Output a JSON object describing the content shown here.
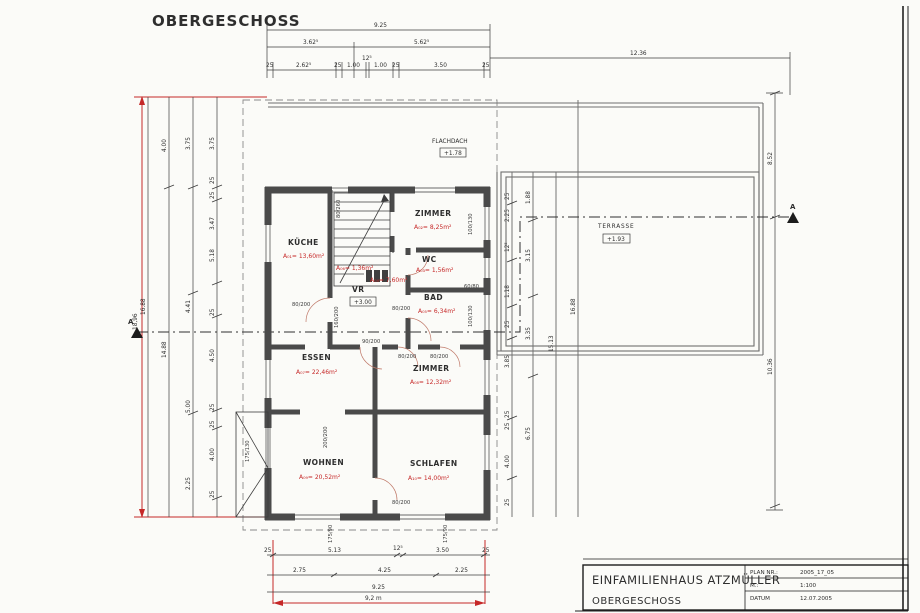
{
  "title": "OBERGESCHOSS",
  "section_marker": "A",
  "labels": {
    "flachdach": "FLACHDACH",
    "flachdach_level": "+1.78",
    "terrasse": "TERRASSE",
    "terrasse_level": "+1.93",
    "vr_level": "+3.00"
  },
  "rooms": [
    {
      "name": "KÜCHE",
      "area": "A₀₁= 13,60m²"
    },
    {
      "name": "ZIMMER",
      "area": "A₀₂= 8,25m²"
    },
    {
      "name": "WC",
      "area": "A₀₃= 1,56m²"
    },
    {
      "name": "VR",
      "area": "A₀₄= 7,60m²"
    },
    {
      "name": "BAD",
      "area": "A₀₅= 6,34m²"
    },
    {
      "name": "",
      "area": "A₀₆= 1,36m²"
    },
    {
      "name": "ESSEN",
      "area": "A₀₇= 22,46m²"
    },
    {
      "name": "ZIMMER",
      "area": "A₀₈= 12,32m²"
    },
    {
      "name": "WOHNEN",
      "area": "A₀₉= 20,52m²"
    },
    {
      "name": "SCHLAFEN",
      "area": "A₁₀= 14,00m²"
    }
  ],
  "dims": {
    "top_total": "9.25",
    "top_row2": [
      "3.62⁵",
      "5.62⁵"
    ],
    "top_row3": [
      "25",
      "2.62⁵",
      "25",
      "1.00",
      "12⁵",
      "1.00",
      "25",
      "3.50",
      "25"
    ],
    "top_right": "12.36",
    "far_right": [
      "8.52",
      "10.36"
    ],
    "left_red_total": "18,96",
    "left_col1": "16.88",
    "left_col2": [
      "4.00",
      "14.88"
    ],
    "left_col3": [
      "3.75",
      "4.41",
      "5.00",
      "2.25"
    ],
    "left_col4": [
      "3.75",
      "25",
      "25",
      "3.47",
      "5.18",
      "25",
      "4.50",
      "25",
      "25",
      "4.00",
      "25"
    ],
    "right_col1": [
      "25",
      "2.25",
      "12⁵",
      "1.18",
      "25",
      "3.85",
      "25",
      "25",
      "4.00",
      "25"
    ],
    "right_col2": [
      "1.88",
      "3.15",
      "3.35",
      "6.75"
    ],
    "right_col3": "15.13",
    "right_col4": "16.88",
    "bottom_row1": [
      "25",
      "5.13",
      "12⁵",
      "3.50",
      "25"
    ],
    "bottom_row2": [
      "2.75",
      "4.25",
      "2.25"
    ],
    "bottom_total": "9.25",
    "bottom_red_total": "9,2 m",
    "openings": [
      "80/260",
      "80/200",
      "90/200",
      "160/200",
      "80/200",
      "80/200",
      "80/200",
      "200/200",
      "80/200",
      "175/90",
      "175/90",
      "175/130",
      "100/130",
      "60/80",
      "100/130"
    ]
  },
  "titleblock": {
    "project": "EINFAMILIENHAUS ATZMÜLLER",
    "sheet": "OBERGESCHOSS",
    "rows": [
      {
        "label": "PLAN NR.:",
        "value": "2005_17_05"
      },
      {
        "label": "M.:",
        "value": "1:100"
      },
      {
        "label": "DATUM",
        "value": "12.07.2005"
      }
    ]
  }
}
